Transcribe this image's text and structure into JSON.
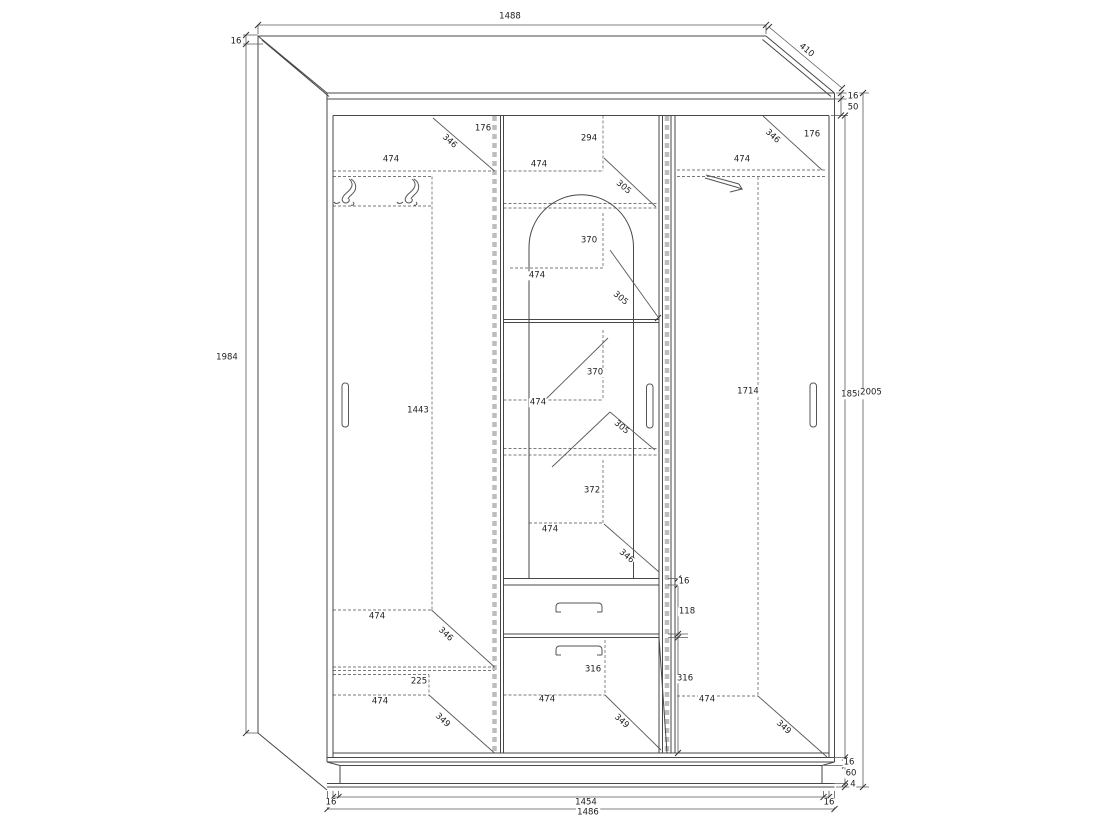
{
  "document": {
    "kind": "furniture technical drawing",
    "subject": "three-door wardrobe, front elevation with oblique top projection"
  },
  "dimensions_summary": {
    "overall_width": "1488",
    "depth": "410",
    "overall_height": "2005",
    "interior_height": "1858",
    "side_panel_height": "1984",
    "panel_thickness": "16",
    "top_frame": "50",
    "plinth_height": "60",
    "bottom_gap": "4",
    "interior_width": "1454",
    "carcass_width": "1486",
    "section_width": "474",
    "drawer_front": "118",
    "lower_front": "316",
    "hanging_height": "1443",
    "right_hanging_height": "1714"
  },
  "labels": [
    {
      "t": "1488",
      "x": 510,
      "y": 17
    },
    {
      "t": "16",
      "x": 236,
      "y": 42
    },
    {
      "t": "410",
      "x": 806,
      "y": 51,
      "r": 40
    },
    {
      "t": "16",
      "x": 853,
      "y": 97
    },
    {
      "t": "50",
      "x": 853,
      "y": 108
    },
    {
      "t": "1984",
      "x": 227,
      "y": 358
    },
    {
      "t": "1858",
      "x": 852,
      "y": 395
    },
    {
      "t": "2005",
      "x": 871,
      "y": 393
    },
    {
      "t": "176",
      "x": 483,
      "y": 129
    },
    {
      "t": "346",
      "x": 449,
      "y": 142,
      "r": 42
    },
    {
      "t": "474",
      "x": 391,
      "y": 160
    },
    {
      "t": "294",
      "x": 589,
      "y": 139
    },
    {
      "t": "474",
      "x": 539,
      "y": 165
    },
    {
      "t": "305",
      "x": 623,
      "y": 188,
      "r": 40
    },
    {
      "t": "346",
      "x": 772,
      "y": 137,
      "r": 42
    },
    {
      "t": "176",
      "x": 812,
      "y": 135
    },
    {
      "t": "474",
      "x": 742,
      "y": 160
    },
    {
      "t": "370",
      "x": 589,
      "y": 241
    },
    {
      "t": "474",
      "x": 537,
      "y": 276
    },
    {
      "t": "305",
      "x": 620,
      "y": 299,
      "r": 40
    },
    {
      "t": "1443",
      "x": 418,
      "y": 411
    },
    {
      "t": "370",
      "x": 595,
      "y": 373
    },
    {
      "t": "474",
      "x": 538,
      "y": 403
    },
    {
      "t": "305",
      "x": 621,
      "y": 428,
      "r": 40
    },
    {
      "t": "1714",
      "x": 748,
      "y": 392
    },
    {
      "t": "372",
      "x": 592,
      "y": 491
    },
    {
      "t": "474",
      "x": 550,
      "y": 530
    },
    {
      "t": "346",
      "x": 626,
      "y": 557,
      "r": 40
    },
    {
      "t": "474",
      "x": 377,
      "y": 617
    },
    {
      "t": "346",
      "x": 445,
      "y": 635,
      "r": 43
    },
    {
      "t": "16",
      "x": 684,
      "y": 582
    },
    {
      "t": "118",
      "x": 687,
      "y": 612
    },
    {
      "t": "225",
      "x": 419,
      "y": 682
    },
    {
      "t": "474",
      "x": 380,
      "y": 702
    },
    {
      "t": "349",
      "x": 442,
      "y": 721,
      "r": 43
    },
    {
      "t": "316",
      "x": 593,
      "y": 670
    },
    {
      "t": "316",
      "x": 685,
      "y": 679
    },
    {
      "t": "474",
      "x": 547,
      "y": 700
    },
    {
      "t": "349",
      "x": 621,
      "y": 722,
      "r": 42
    },
    {
      "t": "474",
      "x": 707,
      "y": 700
    },
    {
      "t": "349",
      "x": 783,
      "y": 728,
      "r": 42
    },
    {
      "t": "16",
      "x": 849,
      "y": 763
    },
    {
      "t": "60",
      "x": 851,
      "y": 774
    },
    {
      "t": "4",
      "x": 853,
      "y": 785
    },
    {
      "t": "16",
      "x": 331,
      "y": 803
    },
    {
      "t": "1454",
      "x": 586,
      "y": 803
    },
    {
      "t": "16",
      "x": 829,
      "y": 803
    },
    {
      "t": "1486",
      "x": 588,
      "y": 813
    }
  ]
}
